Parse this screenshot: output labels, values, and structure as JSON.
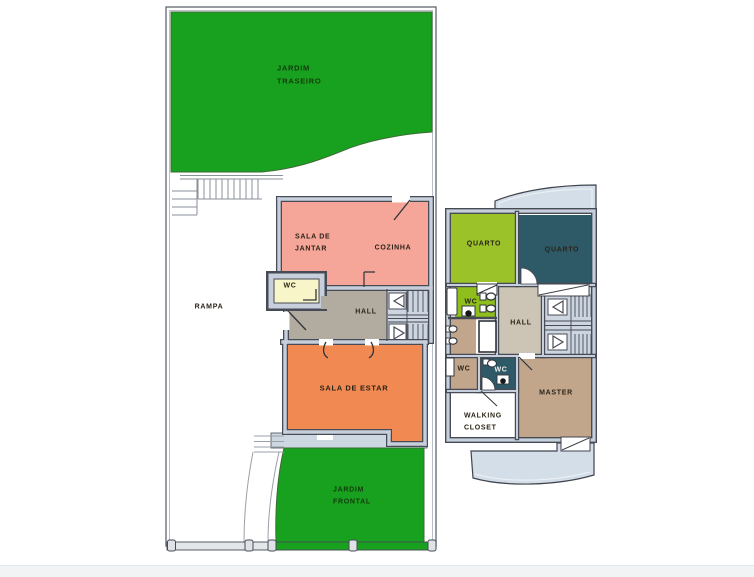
{
  "document": {
    "type": "architectural floor plan, two floors"
  },
  "colors": {
    "garden_green": "#18a11e",
    "salmon": "#f6a698",
    "orange": "#f08a52",
    "wc_yellow": "#f8f6c8",
    "hall_taupe": "#b1aba0",
    "wall_dark": "#474b55",
    "wall_light": "#c6cfdb",
    "olive": "#9cc22a",
    "teal": "#2e5a68",
    "hall_beige": "#ccc4b5",
    "tan": "#c2a68c",
    "balcony_blue": "#d3dee8",
    "porch_blue": "#ccd7e2"
  },
  "labels": {
    "jardim_traseiro_1": "JARDIM",
    "jardim_traseiro_2": "TRASEIRO",
    "sala_jantar_1": "SALA DE",
    "sala_jantar_2": "JANTAR",
    "cozinha": "COZINHA",
    "wc_ground": "WC",
    "hall_ground": "HALL",
    "rampa": "RAMPA",
    "sala_estar": "SALA DE ESTAR",
    "jardim_frontal_1": "JARDIM",
    "jardim_frontal_2": "FRONTAL",
    "quarto_left": "QUARTO",
    "quarto_right": "QUARTO",
    "wc_suite": "WC",
    "hall_upper": "HALL",
    "wc_bath_left": "WC",
    "wc_bath_mid": "WC",
    "master": "MASTER",
    "walking_closet_1": "WALKING",
    "walking_closet_2": "CLOSET"
  },
  "floors": {
    "ground": {
      "rooms": [
        {
          "name": "JARDIM TRASEIRO",
          "color": "#18a11e"
        },
        {
          "name": "SALA DE JANTAR",
          "color": "#f6a698"
        },
        {
          "name": "COZINHA",
          "color": "#f6a698"
        },
        {
          "name": "WC",
          "color": "#f8f6c8"
        },
        {
          "name": "HALL",
          "color": "#b1aba0"
        },
        {
          "name": "RAMPA",
          "color": "#ffffff"
        },
        {
          "name": "SALA DE ESTAR",
          "color": "#f08a52"
        },
        {
          "name": "JARDIM FRONTAL",
          "color": "#18a11e"
        }
      ]
    },
    "upper": {
      "rooms": [
        {
          "name": "QUARTO",
          "color": "#9cc22a"
        },
        {
          "name": "QUARTO",
          "color": "#2e5a68"
        },
        {
          "name": "WC",
          "color": "#8fbf1c"
        },
        {
          "name": "HALL",
          "color": "#ccc4b5"
        },
        {
          "name": "WC",
          "color": "#c2a68c"
        },
        {
          "name": "WC",
          "color": "#2e5a68"
        },
        {
          "name": "MASTER",
          "color": "#c2a68c"
        },
        {
          "name": "WALKING CLOSET",
          "color": "#ffffff"
        }
      ]
    }
  }
}
